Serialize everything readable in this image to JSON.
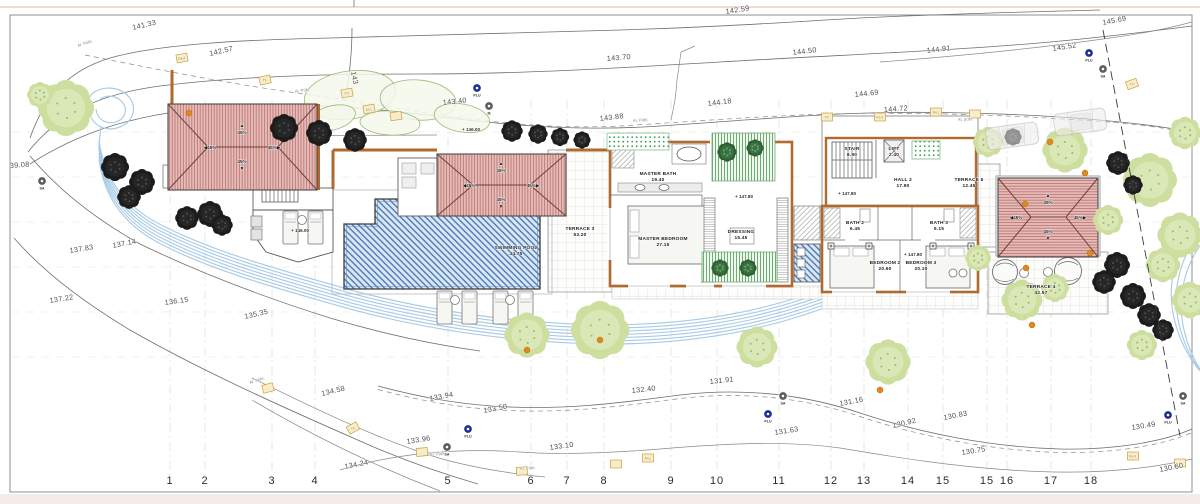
{
  "drawing": {
    "roofs": {
      "slope": "45%",
      "positions": [
        {
          "cx": 242,
          "cy": 147
        },
        {
          "cx": 501,
          "cy": 185
        },
        {
          "cx": 1048,
          "cy": 217
        }
      ]
    },
    "rooms": [
      {
        "name": "MASTER BATH",
        "area": "19.40",
        "x": 658,
        "y": 175
      },
      {
        "name": "MASTER BEDROOM",
        "area": "27.15",
        "x": 663,
        "y": 240
      },
      {
        "name": "DRESSING",
        "area": "15.45",
        "x": 741,
        "y": 233
      },
      {
        "name": "TERRACE 3",
        "area": "53.20",
        "x": 580,
        "y": 230
      },
      {
        "name": "SWIMMING POOL",
        "area": "44.75",
        "x": 516,
        "y": 249
      },
      {
        "name": "STAIR",
        "area": "8.90",
        "x": 852,
        "y": 150
      },
      {
        "name": "LIFT",
        "area": "2.40",
        "x": 894,
        "y": 150
      },
      {
        "name": "HALL 2",
        "area": "17.90",
        "x": 903,
        "y": 181
      },
      {
        "name": "TERRACE 5",
        "area": "12.45",
        "x": 969,
        "y": 181
      },
      {
        "name": "BATH 2",
        "area": "6.45",
        "x": 855,
        "y": 224
      },
      {
        "name": "BATH 3",
        "area": "9.15",
        "x": 939,
        "y": 224
      },
      {
        "name": "BEDROOM 2",
        "area": "20.60",
        "x": 885,
        "y": 264
      },
      {
        "name": "BEDROOM 3",
        "area": "20.10",
        "x": 921,
        "y": 264
      },
      {
        "name": "TERRACE 4",
        "area": "42.57",
        "x": 1041,
        "y": 288
      }
    ],
    "labels": {
      "contours": [
        {
          "t": "141.33",
          "x": 133,
          "y": 30,
          "r": -13
        },
        {
          "t": "142.59",
          "x": 726,
          "y": 14,
          "r": -9
        },
        {
          "t": "142.57",
          "x": 210,
          "y": 56,
          "r": -13
        },
        {
          "t": "143",
          "x": 351,
          "y": 72,
          "r": 78
        },
        {
          "t": "143.70",
          "x": 607,
          "y": 61,
          "r": -5
        },
        {
          "t": "144.50",
          "x": 793,
          "y": 55,
          "r": -7
        },
        {
          "t": "144.91",
          "x": 927,
          "y": 53,
          "r": -7
        },
        {
          "t": "145.69",
          "x": 1103,
          "y": 25,
          "r": -11
        },
        {
          "t": "145.52",
          "x": 1053,
          "y": 51,
          "r": -9
        },
        {
          "t": "143.40",
          "x": 443,
          "y": 105,
          "r": -6
        },
        {
          "t": "143.88",
          "x": 600,
          "y": 121,
          "r": -7
        },
        {
          "t": "144.18",
          "x": 708,
          "y": 106,
          "r": -7
        },
        {
          "t": "144.69",
          "x": 855,
          "y": 97,
          "r": -6
        },
        {
          "t": "144.72",
          "x": 884,
          "y": 112,
          "r": -4
        },
        {
          "t": "39.08",
          "x": 10,
          "y": 168,
          "r": -4
        },
        {
          "t": "137.83",
          "x": 70,
          "y": 253,
          "r": -9
        },
        {
          "t": "137.14",
          "x": 113,
          "y": 248,
          "r": -11
        },
        {
          "t": "137.22",
          "x": 50,
          "y": 303,
          "r": -9
        },
        {
          "t": "136.15",
          "x": 165,
          "y": 305,
          "r": -8
        },
        {
          "t": "135.35",
          "x": 245,
          "y": 319,
          "r": -13
        },
        {
          "t": "134.58",
          "x": 322,
          "y": 396,
          "r": -14
        },
        {
          "t": "134.24",
          "x": 345,
          "y": 469,
          "r": -11
        },
        {
          "t": "133.94",
          "x": 430,
          "y": 401,
          "r": -11
        },
        {
          "t": "133.50",
          "x": 484,
          "y": 413,
          "r": -11
        },
        {
          "t": "133.96",
          "x": 407,
          "y": 444,
          "r": -9
        },
        {
          "t": "133.10",
          "x": 550,
          "y": 450,
          "r": -8
        },
        {
          "t": "132.40",
          "x": 632,
          "y": 393,
          "r": -6
        },
        {
          "t": "131.91",
          "x": 710,
          "y": 384,
          "r": -6
        },
        {
          "t": "131.63",
          "x": 775,
          "y": 435,
          "r": -9
        },
        {
          "t": "131.16",
          "x": 840,
          "y": 406,
          "r": -11
        },
        {
          "t": "130.92",
          "x": 893,
          "y": 428,
          "r": -13
        },
        {
          "t": "130.83",
          "x": 944,
          "y": 420,
          "r": -11
        },
        {
          "t": "130.75",
          "x": 962,
          "y": 455,
          "r": -9
        },
        {
          "t": "130.49",
          "x": 1132,
          "y": 430,
          "r": -9
        },
        {
          "t": "130.60",
          "x": 1160,
          "y": 472,
          "r": -11
        }
      ],
      "levels": [
        {
          "t": "+ 146.00",
          "x": 462,
          "y": 131
        },
        {
          "t": "+ 146.00",
          "x": 291,
          "y": 232
        },
        {
          "t": "+ 147.80",
          "x": 735,
          "y": 198
        },
        {
          "t": "+ 147.80",
          "x": 838,
          "y": 195
        },
        {
          "t": "+ 147.80",
          "x": 904,
          "y": 256
        }
      ],
      "roads": [
        {
          "t": "Al. Públ.",
          "x": 78,
          "y": 47,
          "r": -18
        },
        {
          "t": "Al. Públ.",
          "x": 295,
          "y": 93,
          "r": -9
        },
        {
          "t": "Al. Públ.",
          "x": 633,
          "y": 122,
          "r": -3
        },
        {
          "t": "Al. públ.",
          "x": 958,
          "y": 121,
          "r": -3
        },
        {
          "t": "Al. Públ.",
          "x": 250,
          "y": 384,
          "r": -18
        },
        {
          "t": "Al. Públ.",
          "x": 430,
          "y": 456,
          "r": -5
        },
        {
          "t": "Al. Públ.",
          "x": 520,
          "y": 470,
          "r": -4
        }
      ]
    },
    "grid": {
      "numbers": [
        {
          "n": "1",
          "x": 170
        },
        {
          "n": "2",
          "x": 205
        },
        {
          "n": "3",
          "x": 272
        },
        {
          "n": "4",
          "x": 315
        },
        {
          "n": "5",
          "x": 448
        },
        {
          "n": "6",
          "x": 531
        },
        {
          "n": "7",
          "x": 567
        },
        {
          "n": "8",
          "x": 604
        },
        {
          "n": "9",
          "x": 671
        },
        {
          "n": "10",
          "x": 717
        },
        {
          "n": "11",
          "x": 779
        },
        {
          "n": "12",
          "x": 831
        },
        {
          "n": "13",
          "x": 864
        },
        {
          "n": "14",
          "x": 908
        },
        {
          "n": "15",
          "x": 943
        },
        {
          "n": "15",
          "x": 987
        },
        {
          "n": "16",
          "x": 1007
        },
        {
          "n": "17",
          "x": 1051
        },
        {
          "n": "18",
          "x": 1091
        }
      ]
    },
    "utility_markers": [
      {
        "t": "PLU",
        "x": 477,
        "y": 88
      },
      {
        "t": "M",
        "x": 489,
        "y": 106
      },
      {
        "t": "PLU",
        "x": 1089,
        "y": 53
      },
      {
        "t": "SA",
        "x": 1103,
        "y": 69
      },
      {
        "t": "SA",
        "x": 42,
        "y": 181
      },
      {
        "t": "SA",
        "x": 447,
        "y": 447
      },
      {
        "t": "PLU",
        "x": 468,
        "y": 429
      },
      {
        "t": "SA",
        "x": 783,
        "y": 396
      },
      {
        "t": "PLU",
        "x": 768,
        "y": 414
      },
      {
        "t": "SA",
        "x": 1183,
        "y": 396
      },
      {
        "t": "PLU",
        "x": 1168,
        "y": 415
      }
    ],
    "utility_boxes": [
      {
        "t": "Red.",
        "x": 182,
        "y": 58,
        "r": -10
      },
      {
        "t": "Tif.",
        "x": 265,
        "y": 80,
        "r": -12
      },
      {
        "t": "Tif.",
        "x": 347,
        "y": 93,
        "r": -10
      },
      {
        "t": "Arq.",
        "x": 369,
        "y": 109,
        "r": -8
      },
      {
        "t": "",
        "x": 396,
        "y": 116,
        "r": -8
      },
      {
        "t": "Tif.",
        "x": 827,
        "y": 117,
        "r": 0
      },
      {
        "t": "Red.",
        "x": 880,
        "y": 117,
        "r": 0
      },
      {
        "t": "Arq.",
        "x": 936,
        "y": 112,
        "r": 0
      },
      {
        "t": "",
        "x": 975,
        "y": 114,
        "r": 0
      },
      {
        "t": "Tif.",
        "x": 1132,
        "y": 84,
        "r": -20
      },
      {
        "t": "",
        "x": 268,
        "y": 388,
        "r": -15
      },
      {
        "t": "Tif.",
        "x": 353,
        "y": 428,
        "r": -30
      },
      {
        "t": "",
        "x": 422,
        "y": 452,
        "r": -5
      },
      {
        "t": "",
        "x": 522,
        "y": 471,
        "r": -4
      },
      {
        "t": "",
        "x": 616,
        "y": 464,
        "r": 0
      },
      {
        "t": "Arq.",
        "x": 648,
        "y": 458,
        "r": 0
      },
      {
        "t": "Red.",
        "x": 1133,
        "y": 456,
        "r": 0
      },
      {
        "t": "",
        "x": 1180,
        "y": 463,
        "r": 0
      }
    ],
    "colors": {
      "roof": "#e6bcb8",
      "roof_stripe": "#b46a65",
      "wall": "#b06a2e",
      "pool_hatch": "#3e6fae",
      "stream": "#a8cbe6",
      "plu_marker": "#1d2f93",
      "utility_box": "#f8edc8"
    }
  }
}
